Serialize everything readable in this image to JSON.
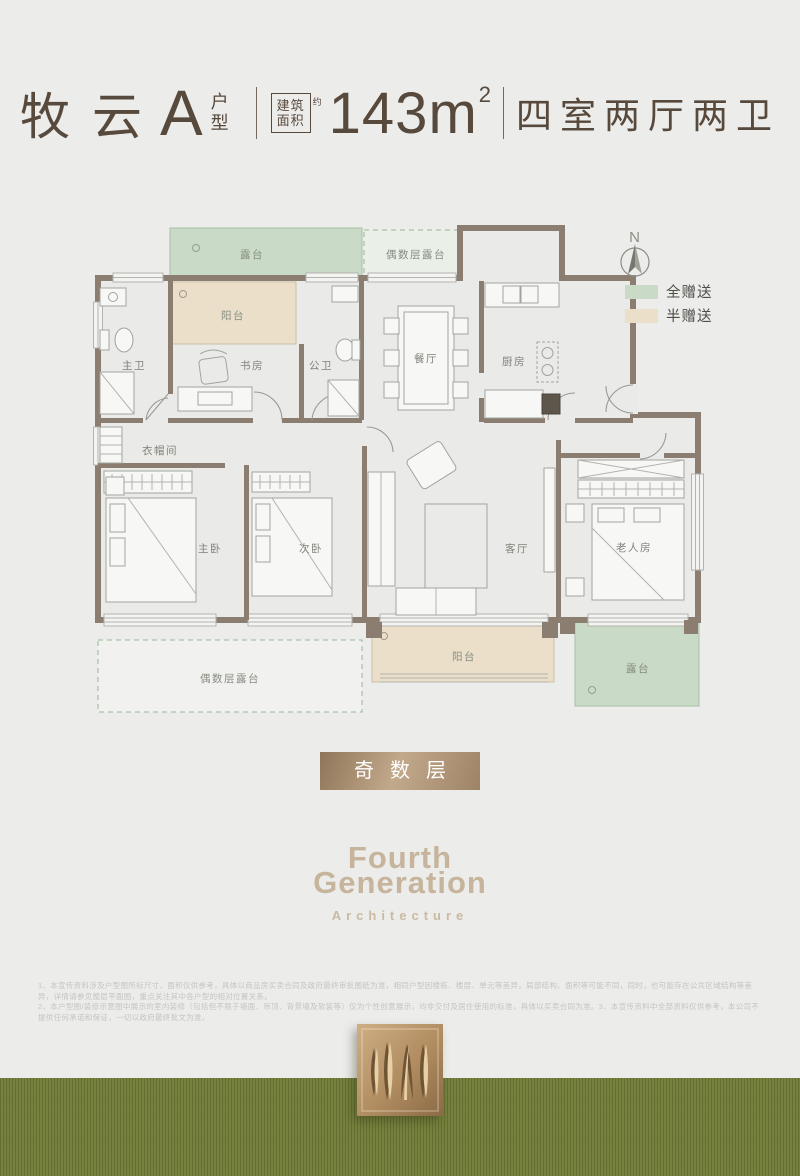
{
  "header": {
    "name": "牧云",
    "unit_letter": "A",
    "unit_suffix_top": "户",
    "unit_suffix_bottom": "型",
    "area_box_top": "建筑",
    "area_box_bottom": "面积",
    "area_approx": "约",
    "area_value": "143m",
    "area_exponent": "2",
    "layout_summary": "四室两厅两卫"
  },
  "compass": {
    "north_label": "N"
  },
  "legend": {
    "full_gift_label": "全赠送",
    "half_gift_label": "半赠送",
    "full_gift_color": "#c9dac6",
    "half_gift_color": "#ebdfca"
  },
  "floorplan": {
    "rooms": {
      "terrace_top": "露台",
      "even_floor_terrace_top": "偶数层露台",
      "balcony_top": "阳台",
      "master_bath": "主卫",
      "study": "书房",
      "guest_bath": "公卫",
      "dining": "餐厅",
      "kitchen": "厨房",
      "cloakroom": "衣帽间",
      "master_bedroom": "主卧",
      "second_bedroom": "次卧",
      "living": "客厅",
      "elder_room": "老人房",
      "balcony_bottom": "阳台",
      "even_floor_terrace_bottom": "偶数层露台",
      "terrace_bottom": "露台"
    }
  },
  "floor_badge": {
    "label": "奇数层"
  },
  "brand": {
    "line1": "Fourth",
    "line2": "Generation",
    "line3": "Architecture"
  },
  "disclaimer": {
    "line1": "1、本宣传资料涉及户型图所标尺寸、面积仅供参考，具体以商品房买卖合同及政府最终审批图纸为准，相同户型因楼栋、楼层、单元等差异，局部结构、面积等可能不同，同时，也可能存在公共区域结构等差异，详情请参见整层平面图，重点关注其中各户型的相对位置关系。",
    "line2": "2、本户型图/装修示意图中展示的室内装修（包括但不限于墙面、吊顶、背景墙及软装等）仅为个性创意展示，均非交付及居住使用的标准，具体以买卖合同为准。3、本宣传资料中全部资料仅供参考，本公司不提供任何承诺和保证，一切以政府最终批文为准。"
  }
}
